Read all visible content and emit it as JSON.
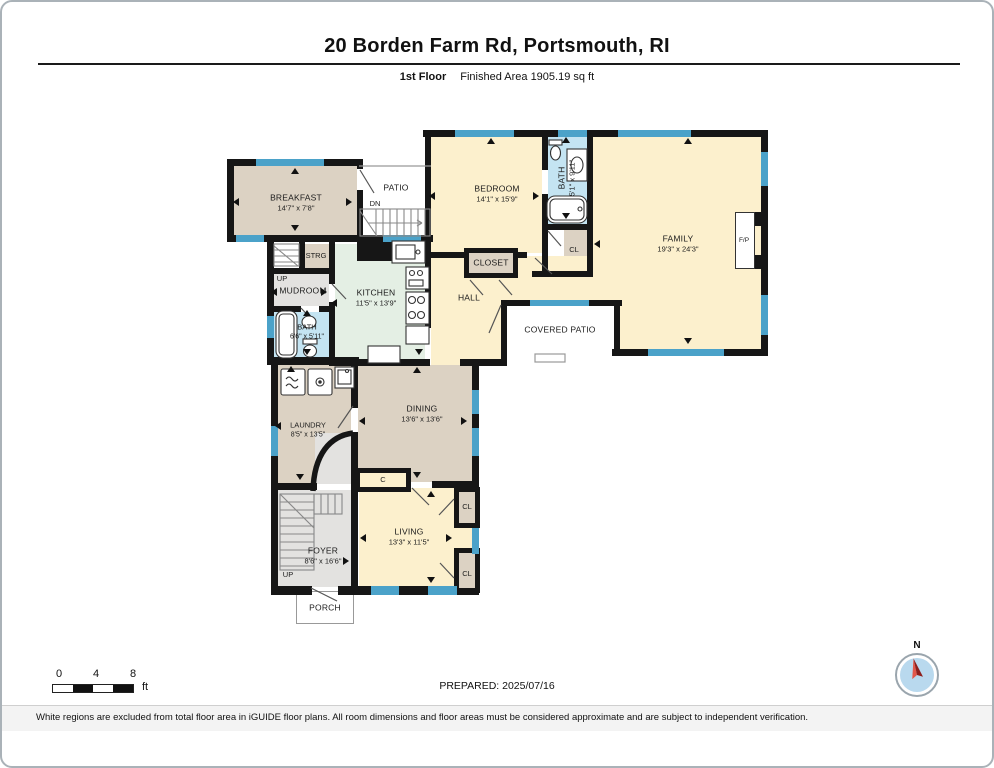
{
  "header": {
    "title": "20 Borden Farm Rd, Portsmouth, RI",
    "floor_label": "1st Floor",
    "area_label": "Finished Area 1905.19 sq ft"
  },
  "rooms": {
    "breakfast": {
      "name": "BREAKFAST",
      "dims": "14'7\" x 7'8\""
    },
    "patio": {
      "name": "PATIO",
      "stair_label": "DN"
    },
    "bedroom": {
      "name": "BEDROOM",
      "dims": "14'1\" x 15'9\""
    },
    "bath_upper": {
      "name": "BATH",
      "dims": "5'1\" x 9'11\""
    },
    "closet_upper": {
      "name": "CL"
    },
    "family": {
      "name": "FAMILY",
      "dims": "19'3\" x 24'3\"",
      "fireplace_label": "F/P"
    },
    "kitchen": {
      "name": "KITCHEN",
      "dims": "11'5\" x 13'9\""
    },
    "storage": {
      "name": "STRG"
    },
    "mudroom": {
      "name": "MUDROOM",
      "stair_label": "UP"
    },
    "bath_lower": {
      "name": "BATH",
      "dims": "6'6\" x 5'11\""
    },
    "hall": {
      "name": "HALL"
    },
    "closet_hall": {
      "name": "CLOSET"
    },
    "covered_patio": {
      "name": "COVERED PATIO"
    },
    "laundry": {
      "name": "LAUNDRY",
      "dims": "8'5\" x 13'5\""
    },
    "dining": {
      "name": "DINING",
      "dims": "13'6\" x 13'6\""
    },
    "closet_c": {
      "name": "C"
    },
    "foyer": {
      "name": "FOYER",
      "dims": "8'6\" x 16'6\"",
      "stair_label": "UP"
    },
    "living": {
      "name": "LIVING",
      "dims": "13'3\" x 11'5\""
    },
    "closet_living_upper": {
      "name": "CL"
    },
    "closet_living_lower": {
      "name": "CL"
    },
    "porch": {
      "name": "PORCH"
    }
  },
  "footer": {
    "scale_bar": {
      "tick_0": "0",
      "tick_4": "4",
      "tick_8": "8",
      "unit": "ft"
    },
    "prepared_label": "PREPARED: 2025/07/16",
    "compass": {
      "label": "N"
    },
    "disclaimer": "White regions are excluded from total floor area in iGUIDE floor plans. All room dimensions and floor areas must be considered approximate and are subject to independent verification."
  },
  "colors": {
    "wall": "#161616",
    "window_marker": "#4ba2c9",
    "room_tan": "#dcd2c3",
    "room_cream": "#fcf0cd",
    "room_mint": "#e4efe4",
    "room_blue": "#c4e4f2",
    "room_gray": "#e3e2e0",
    "compass_needle": "#cc2a1e"
  },
  "icons": {
    "compass": "compass-rose-icon",
    "dimension_arrow": "triangle-pointer-icon"
  }
}
